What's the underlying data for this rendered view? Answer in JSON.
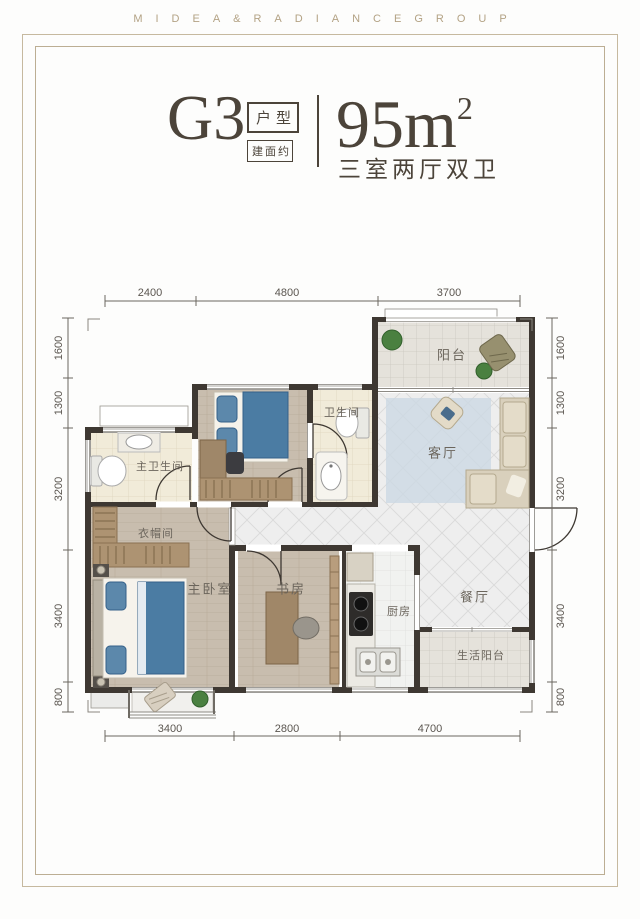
{
  "header": {
    "brand": "MIDEA&RADIANCEGROUP"
  },
  "title": {
    "unit_code": "G3",
    "tag_type": "户型",
    "tag_area_prefix": "建面约",
    "area_value": "95m",
    "area_exponent": "2",
    "layout_desc": "三室两厅双卫"
  },
  "dimensions": {
    "top": [
      "2400",
      "4800",
      "3700"
    ],
    "bottom": [
      "3400",
      "2800",
      "4700"
    ],
    "left": [
      "1600",
      "1300",
      "3200",
      "3400",
      "800"
    ],
    "right": [
      "1600",
      "1300",
      "3200",
      "3400",
      "800"
    ]
  },
  "rooms": {
    "balcony": "阳台",
    "living_room": "客厅",
    "bathroom": "卫生间",
    "master_bathroom": "主卫生间",
    "cloakroom": "衣帽间",
    "master_bedroom": "主卧室",
    "study": "书房",
    "kitchen": "厨房",
    "dining_room": "餐厅",
    "service_balcony": "生活阳台"
  },
  "colors": {
    "brand_gold": "#b3a284",
    "title_brown": "#4c443a",
    "wall": "#3e3832",
    "wood_floor": "#c8bdae",
    "cream_tile": "#f1ebd9",
    "diag_tile": "#eeeeee",
    "rug_blue": "#ccd8e3",
    "bed_blue": "#4b7ca3",
    "sofa_beige": "#d9d0bc",
    "plant_green": "#4a8040"
  }
}
